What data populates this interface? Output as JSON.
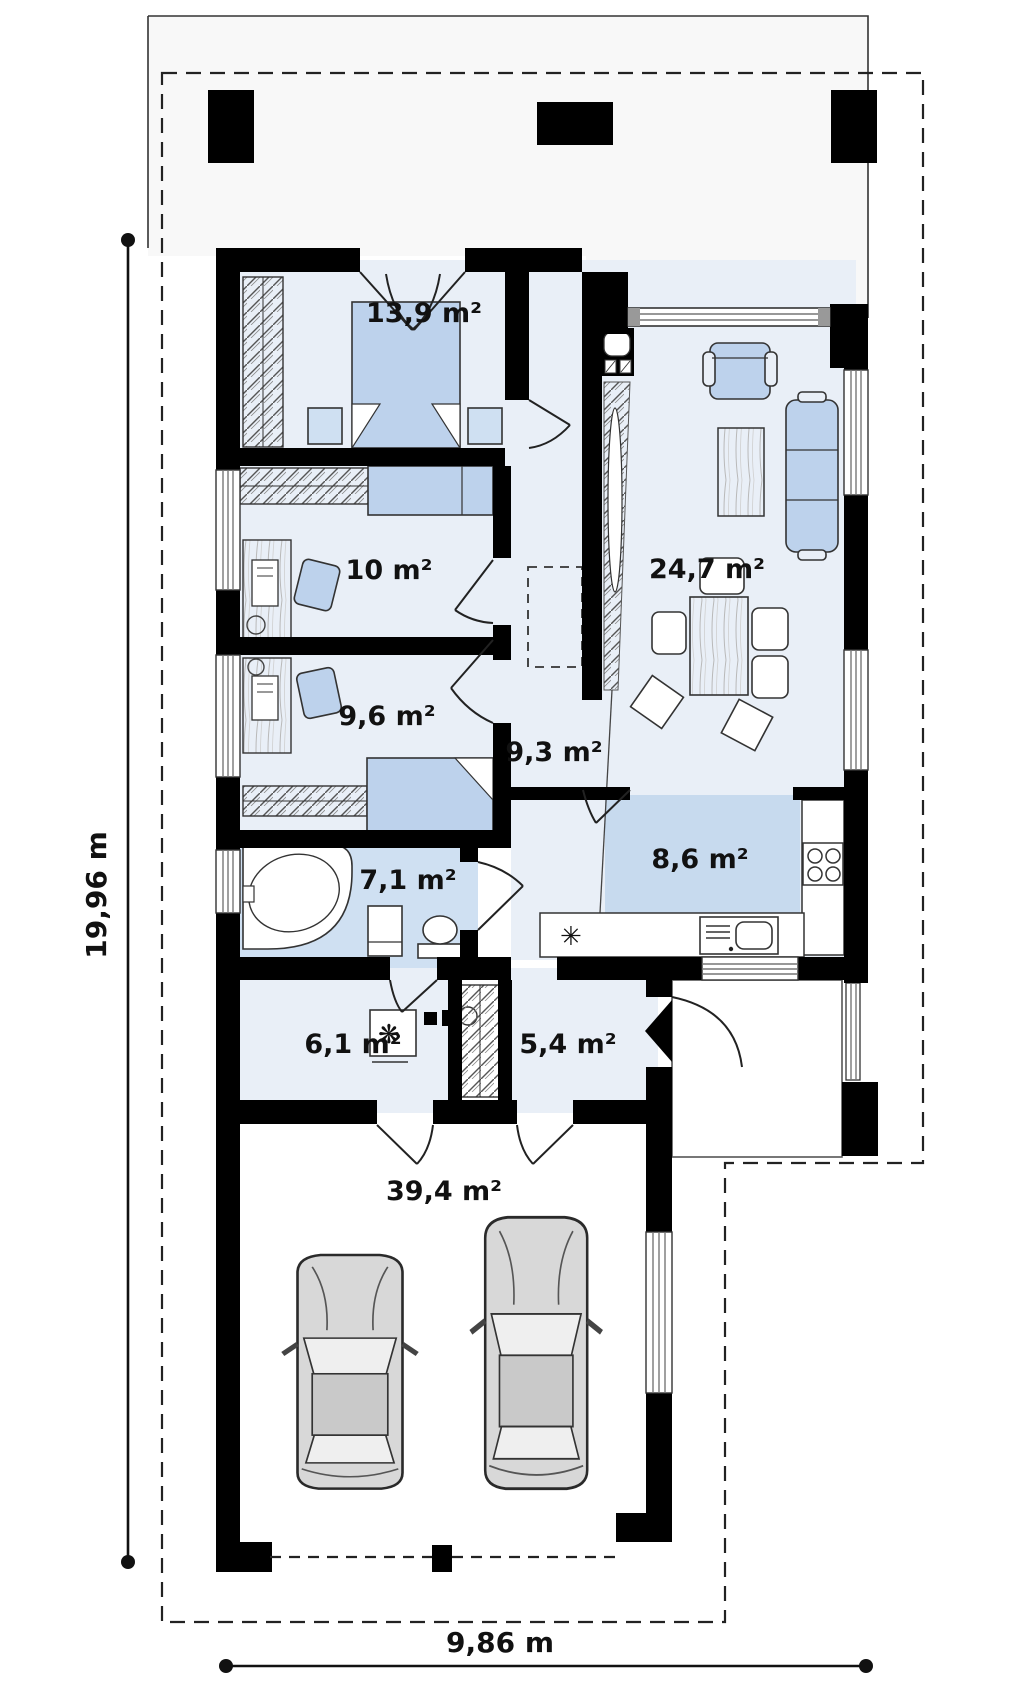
{
  "plan": {
    "rooms": [
      {
        "name": "bedroom",
        "label": "13,9 m²"
      },
      {
        "name": "room-10",
        "label": "10 m²"
      },
      {
        "name": "room-9-6",
        "label": "9,6 m²"
      },
      {
        "name": "hallway",
        "label": "9,3 m²"
      },
      {
        "name": "living-room",
        "label": "24,7 m²"
      },
      {
        "name": "kitchen",
        "label": "8,6 m²"
      },
      {
        "name": "bathroom",
        "label": "7,1 m²"
      },
      {
        "name": "utility-room",
        "label": "6,1 m²"
      },
      {
        "name": "entrance-hall",
        "label": "5,4 m²"
      },
      {
        "name": "garage",
        "label": "39,4 m²"
      }
    ],
    "dimensions": {
      "left_total": "19,96 m",
      "bottom_total": "9,86 m"
    },
    "symbols": {
      "boiler": "❋",
      "hob": "✳"
    },
    "colors": {
      "wall": "#000000",
      "floor": "#e9eff7",
      "wet_floor": "#cfe0f2",
      "island": "#c7daee",
      "soft_furniture": "#bdd2ec",
      "car_body": "#d8d8d8"
    }
  }
}
